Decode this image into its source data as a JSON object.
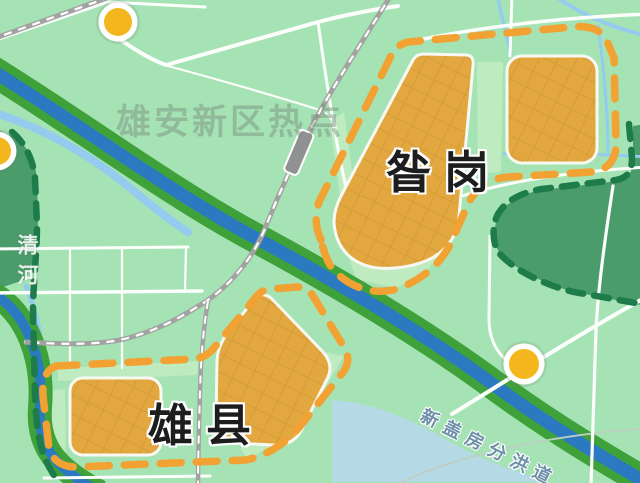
{
  "map": {
    "watermark": "雄安新区热点",
    "labels": {
      "zangang": "昝岗",
      "xiongxian": "雄县"
    },
    "river_label": "清河",
    "channel_label": "新盖房分洪道",
    "poi_marker_count": 3,
    "colors": {
      "base_green": "#a6e3b4",
      "river_blue": "#2b7ac1",
      "river_bank_green": "#3fa139",
      "stream_blue": "#96cbf0",
      "pale_water": "#b7d8eb",
      "urban_block_orange": "#e2a73e",
      "boundary_dash_orange": "#f2a232",
      "protected_fill_green": "#4a9c6b",
      "protected_dash_green": "#1e7b4a",
      "road_white": "#fcfefc",
      "railway_gray": "#a2a2a2",
      "poi_yellow": "#f3b61d",
      "label_black": "#1d1d1d",
      "channel_text_blue": "#6e8fa8"
    }
  }
}
